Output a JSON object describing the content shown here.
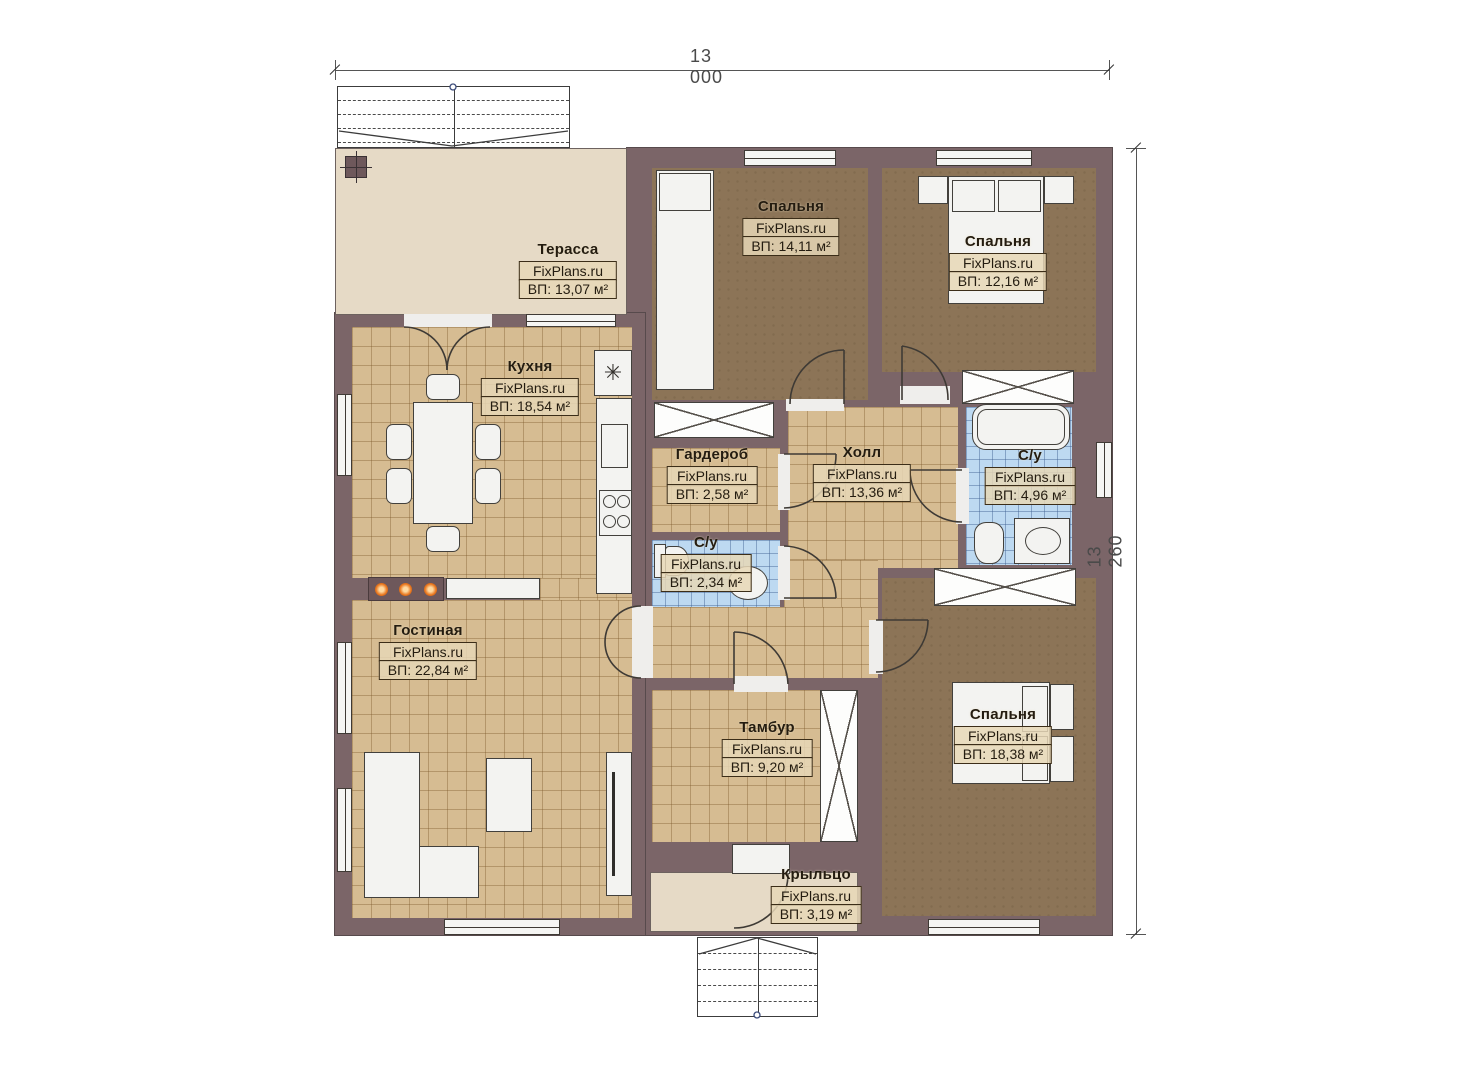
{
  "brand": "FixPlans.ru",
  "dimensions": {
    "top": "13 000",
    "right": "13 260"
  },
  "rooms": [
    {
      "id": "terrace",
      "name": "Терасса",
      "area": "ВП: 13,07 м²"
    },
    {
      "id": "kitchen",
      "name": "Кухня",
      "area": "ВП: 18,54 м²"
    },
    {
      "id": "bedroom-1",
      "name": "Спальня",
      "area": "ВП: 14,11 м²"
    },
    {
      "id": "bedroom-2",
      "name": "Спальня",
      "area": "ВП: 12,16 м²"
    },
    {
      "id": "wardrobe",
      "name": "Гардероб",
      "area": "ВП: 2,58 м²"
    },
    {
      "id": "hall",
      "name": "Холл",
      "area": "ВП: 13,36 м²"
    },
    {
      "id": "bathroom-1",
      "name": "С/у",
      "area": "ВП: 4,96 м²"
    },
    {
      "id": "bathroom-2",
      "name": "С/у",
      "area": "ВП: 2,34 м²"
    },
    {
      "id": "living-room",
      "name": "Гостиная",
      "area": "ВП: 22,84 м²"
    },
    {
      "id": "vestibule",
      "name": "Тамбур",
      "area": "ВП: 9,20 м²"
    },
    {
      "id": "bedroom-3",
      "name": "Спальня",
      "area": "ВП: 18,38 м²"
    },
    {
      "id": "porch",
      "name": "Крыльцо",
      "area": "ВП: 3,19 м²"
    }
  ],
  "icons": {
    "fridge": "✳"
  },
  "colors": {
    "wall": "#7b6568",
    "floor_tile": "#d6bc92",
    "floor_bedroom": "#8c7457",
    "floor_bath": "#bdd9f1",
    "floor_terrace": "#e6dac6",
    "fireplace_dots": "#e8761e"
  }
}
